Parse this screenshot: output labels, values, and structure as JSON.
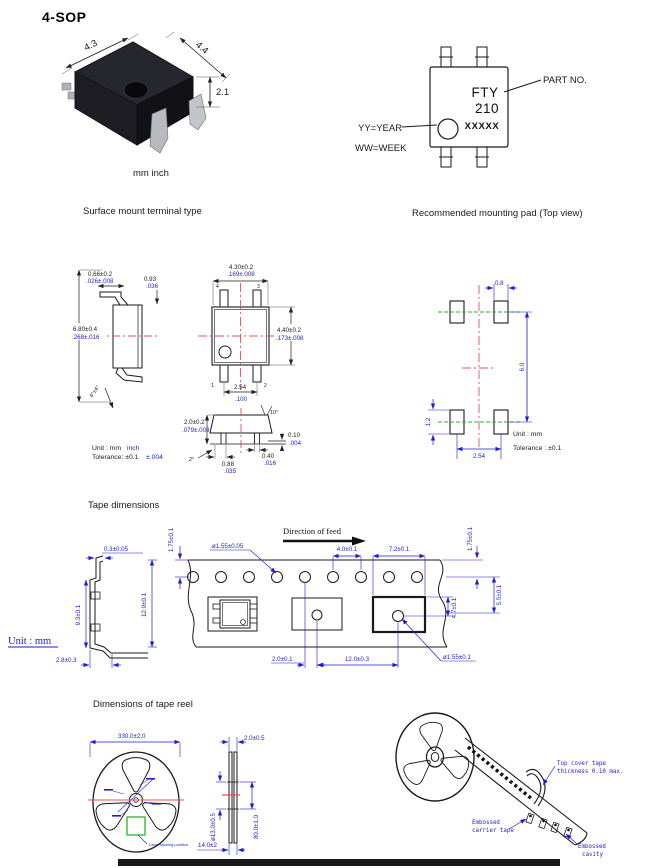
{
  "title": "4-SOP",
  "photo": {
    "dim_left": "4.3",
    "dim_right": "4.4",
    "dim_height": "2.1",
    "units": "mm inch"
  },
  "marking": {
    "line1": "FTY",
    "line2": "210",
    "line3": "XXXXX",
    "part_no": "PART NO.",
    "year": "YY=YEAR",
    "week": "WW=WEEK"
  },
  "captions": {
    "surface_mount": "Surface mount terminal type",
    "mounting_pad": "Recommended mounting pad (Top view)",
    "tape": "Tape dimensions",
    "reel": "Dimensions of tape reel"
  },
  "outline": {
    "side": {
      "lead_w_mm": "0.66±0.2",
      "lead_w_in": ".026±.008",
      "offset_mm": "0.93",
      "offset_in": ".036",
      "span_mm": "6.80±0.4",
      "span_in": ".268±.016",
      "angle": "4°±4°"
    },
    "top": {
      "width_mm": "4.30±0.2",
      "width_in": ".169±.008",
      "depth_mm": "4.40±0.2",
      "depth_in": ".173±.008",
      "pitch_mm": "2.54",
      "pitch_in": ".100",
      "pin1": "1",
      "pin2": "2",
      "pin3": "3",
      "pin4": "4"
    },
    "front": {
      "height_mm": "2.0±0.2",
      "height_in": ".079±.008",
      "angle_top": "10°",
      "standoff_mm": "0.10",
      "standoff_in": ".004",
      "angle_lead": "2°",
      "foot_mm": "0.88",
      "foot_in": ".035",
      "lead_mm": "0.40",
      "lead_in": ".016"
    },
    "note_unit": "Unit : mm",
    "note_unit_in": "inch",
    "note_tol": "Tolerance: ±0.1",
    "note_tol_in": "±.004"
  },
  "pad": {
    "width": "0.8",
    "span_v": "6.0",
    "height": "1.2",
    "pitch": "2.54",
    "unit": "Unit : mm",
    "tolerance": "Tolerance : ±0.1"
  },
  "tape": {
    "feed": "Direction of feed",
    "sprocket_dia": "ø1.55±0.05",
    "thickness": "0.3±0.05",
    "edge_left": "1.75±0.1",
    "edge_right": "1.75±0.1",
    "hole_pitch": "4.0±0.1",
    "pocket_w": "7.2±0.1",
    "width": "12.0±0.1",
    "section_h": "9.3±0.1",
    "emboss": "2.8±0.3",
    "hole_offset": "2.0±0.1",
    "pocket_pitch": "12.0±0.3",
    "center_hole": "ø1.55±0.1",
    "dim_55": "5.5±0.1",
    "dim_47": "4.7±0.1",
    "unit": "Unit : mm"
  },
  "reel": {
    "diameter": "330.0±2.0",
    "label_pos": "Label sticking position",
    "side_w": "2.0±0.5",
    "hub_dia": "ø13.0±0.5",
    "inner_dia": "80.0±1.0",
    "total_w": "14.0±2"
  },
  "reel3d": {
    "cover_line1": "Top cover tape",
    "cover_line2": "thickness 0.10 max.",
    "carrier_line1": "Embossed",
    "carrier_line2": "carrier tape",
    "cavity_line1": "Embossed",
    "cavity_line2": "cavity"
  }
}
